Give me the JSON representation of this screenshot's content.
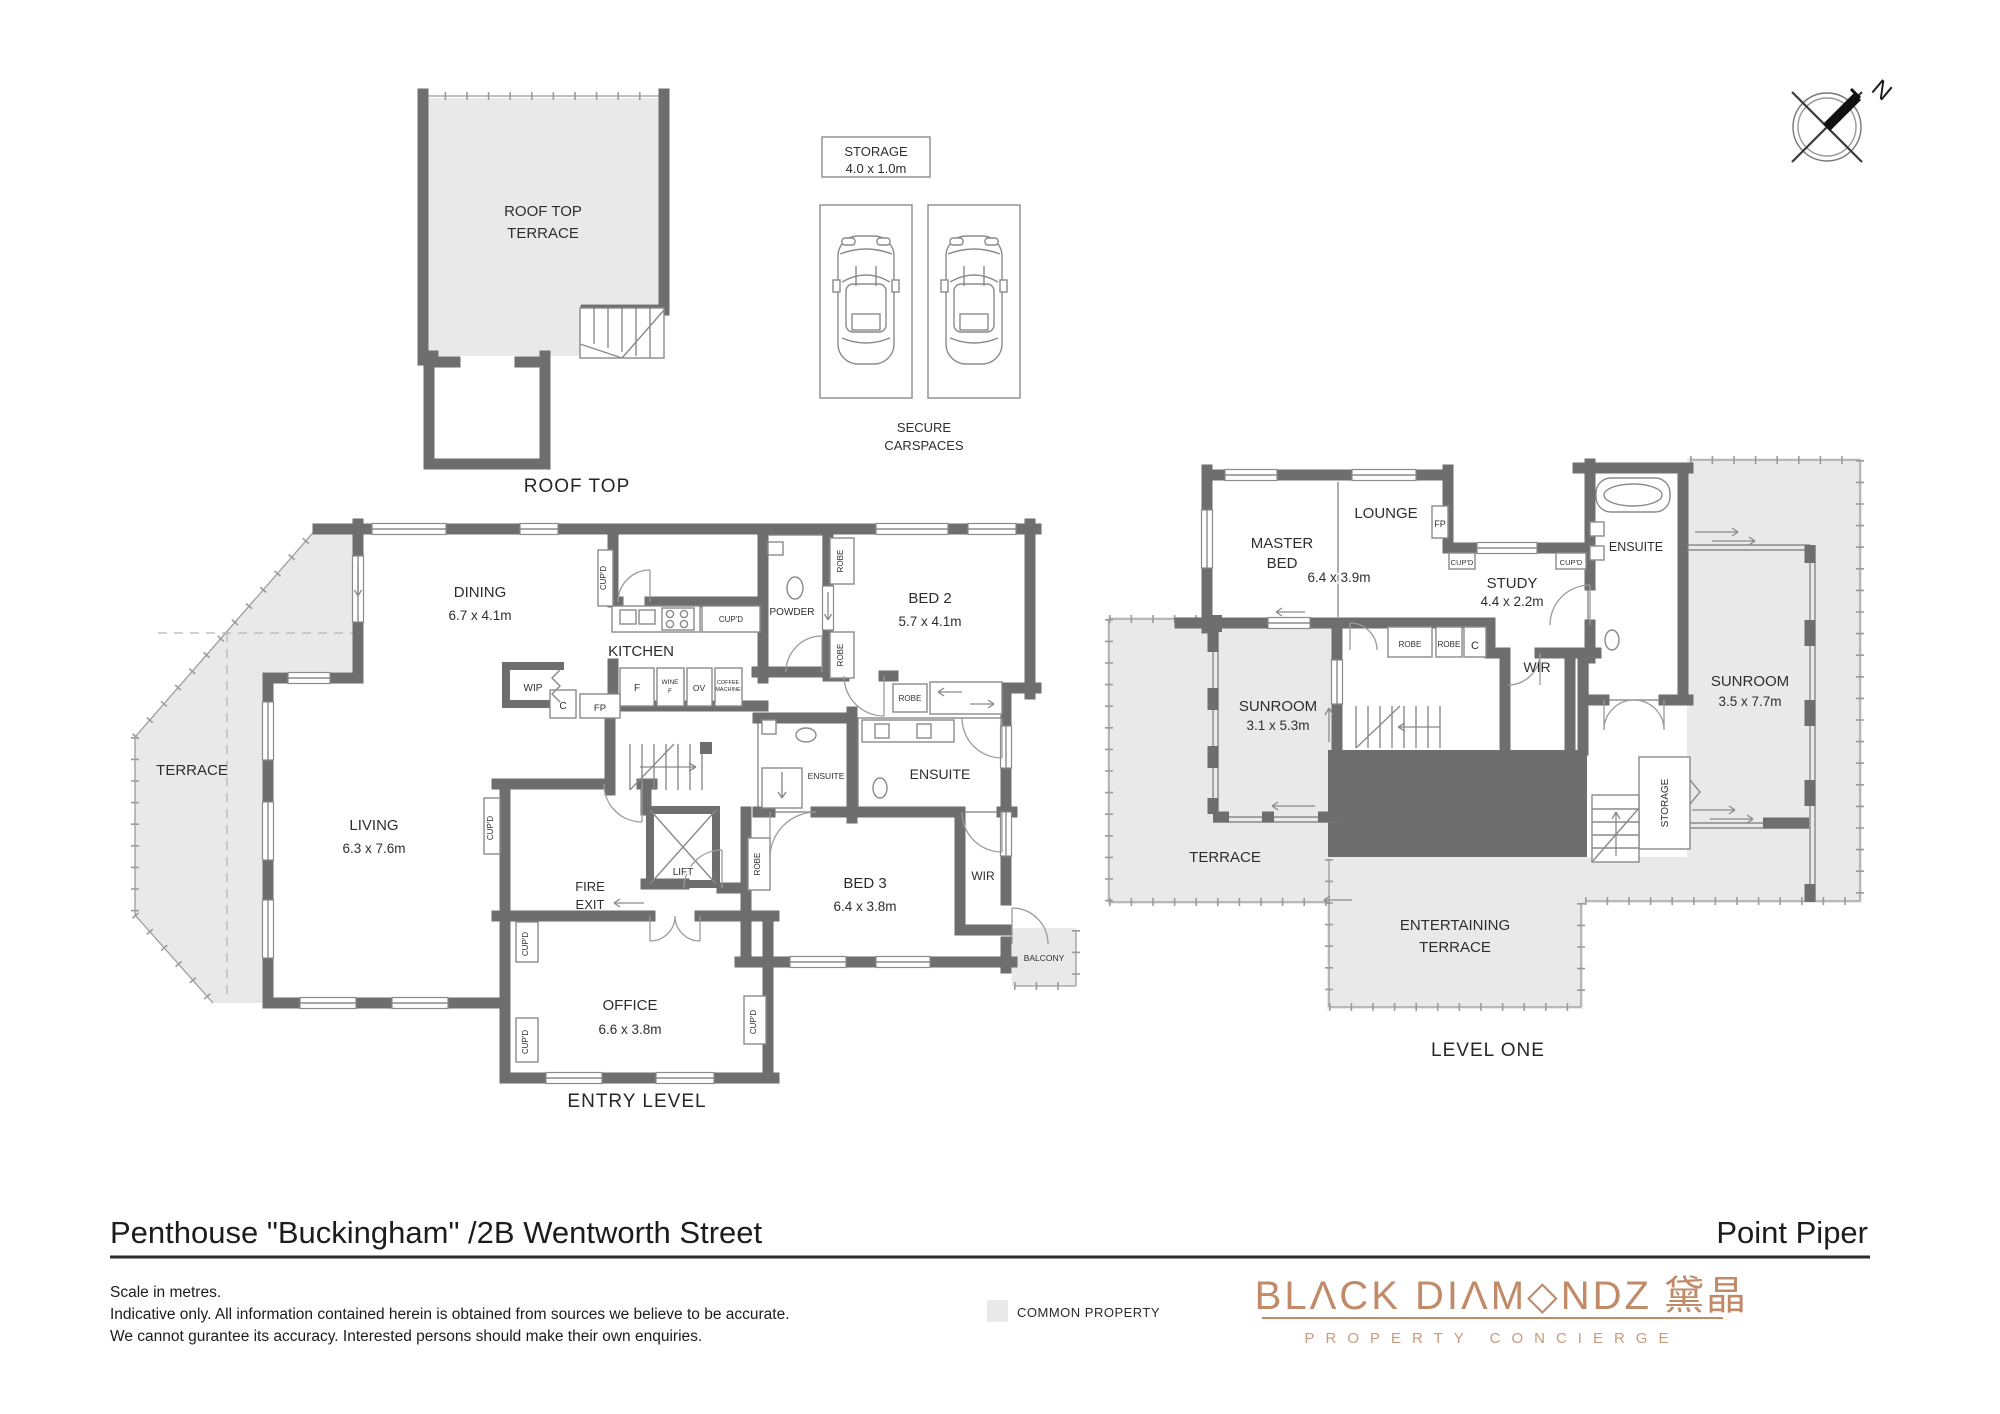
{
  "footer": {
    "title": "Penthouse \"Buckingham\" /2B Wentworth Street",
    "location": "Point Piper",
    "note1": "Scale in metres.",
    "note2": "Indicative only. All information contained herein is obtained from sources we believe to be accurate.",
    "note3": "We cannot gurantee its accuracy. Interested persons should make their own enquiries.",
    "legend_common_property": "COMMON PROPERTY",
    "brand_wordmark": "BLΛCK DIΛM◇NDZ",
    "brand_cjk": "黛晶",
    "brand_tagline": "PROPERTY CONCIERGE"
  },
  "compass": {
    "north": "N"
  },
  "roof": {
    "terrace1": "ROOF TOP",
    "terrace2": "TERRACE",
    "plan": "ROOF TOP"
  },
  "parking": {
    "storage": "STORAGE",
    "storage_dims": "4.0 x 1.0m",
    "secure1": "SECURE",
    "secure2": "CARSPACES"
  },
  "entry": {
    "plan": "ENTRY LEVEL",
    "dining": "DINING",
    "dining_dims": "6.7 x 4.1m",
    "kitchen": "KITCHEN",
    "living": "LIVING",
    "living_dims": "6.3 x 7.6m",
    "terrace": "TERRACE",
    "bed2": "BED 2",
    "bed2_dims": "5.7 x 4.1m",
    "bed3": "BED 3",
    "bed3_dims": "6.4 x 3.8m",
    "office": "OFFICE",
    "office_dims": "6.6 x 3.8m",
    "powder": "POWDER",
    "ensuite": "ENSUITE",
    "wir": "WIR",
    "balcony": "BALCONY",
    "lift": "LIFT",
    "fire1": "FIRE",
    "fire2": "EXIT",
    "wip": "WIP",
    "f": "F",
    "wine1": "WINE",
    "wine2": "F",
    "ov": "OV",
    "coffee1": "COFFEE",
    "coffee2": "MACHINE",
    "c": "C",
    "fp": "FP",
    "robe": "ROBE",
    "cupd": "CUP'D"
  },
  "level1": {
    "plan": "LEVEL ONE",
    "master1": "MASTER",
    "master2": "BED",
    "master_dims": "6.4 x 3.9m",
    "lounge": "LOUNGE",
    "study": "STUDY",
    "study_dims": "4.4 x 2.2m",
    "ensuite": "ENSUITE",
    "wir": "WIR",
    "sunroom": "SUNROOM",
    "sunroom_a_dims": "3.1 x 5.3m",
    "sunroom_b_dims": "3.5 x 7.7m",
    "terrace": "TERRACE",
    "ent1": "ENTERTAINING",
    "ent2": "TERRACE",
    "storage": "STORAGE",
    "fp": "FP",
    "c": "C",
    "robe": "ROBE",
    "cupd": "CUP'D"
  }
}
